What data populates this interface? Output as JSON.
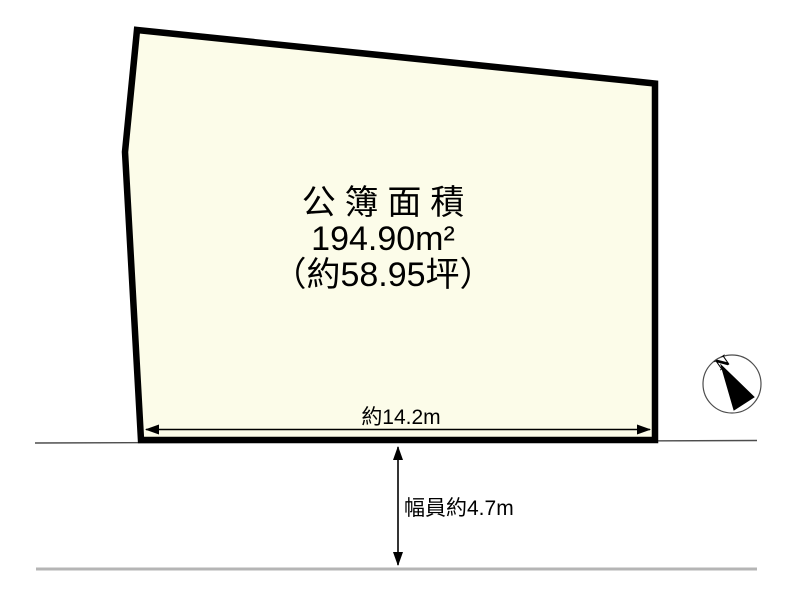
{
  "colors": {
    "background": "#ffffff",
    "plot_fill": "#fcfce9",
    "plot_border": "#000000",
    "dimension": "#000000",
    "road_edge": "#4d4d4d",
    "road_far_edge": "#b5b5b5",
    "compass_ring": "#4d4d4d",
    "compass_needle": "#000000",
    "text": "#000000"
  },
  "plot": {
    "area_title": "公簿面積",
    "area_value": "194.90m²",
    "area_tsubo": "（約58.95坪）"
  },
  "dimensions": {
    "frontage_label": "約14.2m",
    "road_width_label": "幅員約4.7m"
  },
  "compass": {
    "north_label": "N"
  }
}
